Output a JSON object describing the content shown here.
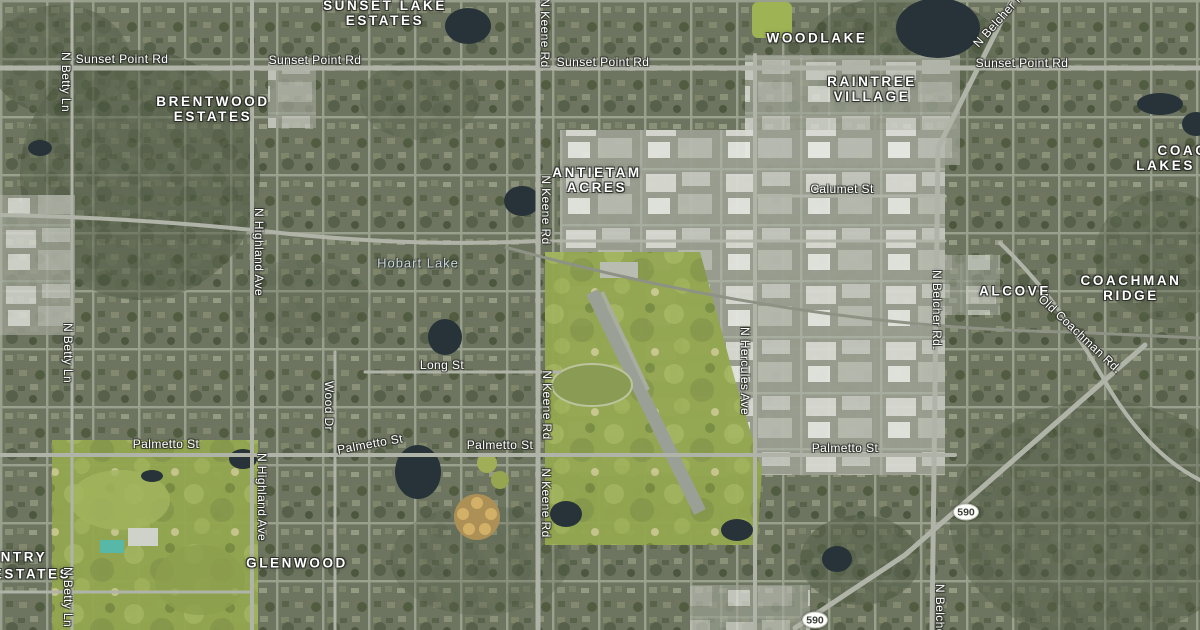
{
  "map": {
    "type": "satellite",
    "colors": {
      "label_text": "#ffffff",
      "water_label_text": "#c9d3d9",
      "residential": "#6d7560",
      "trees": "#4d5740",
      "golf": "#93a64f",
      "industrial_roof": "#d8dad3",
      "road": "#b0b4a8",
      "water": "#273339",
      "shield_bg": "#fdfdf9"
    },
    "place_labels": [
      {
        "lines": [
          "SUNSET LAKE",
          "ESTATES"
        ],
        "x": 385,
        "y": 13
      },
      {
        "lines": [
          "WOODLAKE"
        ],
        "x": 817,
        "y": 38
      },
      {
        "lines": [
          "BRENTWOOD",
          "ESTATES"
        ],
        "x": 213,
        "y": 109
      },
      {
        "lines": [
          "RAINTREE",
          "VILLAGE"
        ],
        "x": 872,
        "y": 89
      },
      {
        "lines": [
          "ANTIETAM",
          "ACRES"
        ],
        "x": 597,
        "y": 180
      },
      {
        "lines": [
          "COACHMAN",
          "LAKES ESTATES"
        ],
        "x": 1208,
        "y": 158
      },
      {
        "lines": [
          "ALCOVE"
        ],
        "x": 1015,
        "y": 291
      },
      {
        "lines": [
          "COACHMAN",
          "RIDGE"
        ],
        "x": 1131,
        "y": 288
      },
      {
        "lines": [
          "GLENWOOD"
        ],
        "x": 297,
        "y": 563
      },
      {
        "lines": [
          "COUNTRY"
        ],
        "x": 5,
        "y": 557
      },
      {
        "lines": [
          "ESTATES"
        ],
        "x": 32,
        "y": 574
      }
    ],
    "road_labels": [
      {
        "text": "Sunset Point Rd",
        "x": 122,
        "y": 59,
        "rotate": 0
      },
      {
        "text": "Sunset Point Rd",
        "x": 315,
        "y": 60,
        "rotate": 0
      },
      {
        "text": "Sunset Point Rd",
        "x": 603,
        "y": 62,
        "rotate": 0
      },
      {
        "text": "Sunset Point Rd",
        "x": 1022,
        "y": 63,
        "rotate": 0
      },
      {
        "text": "N Betty Ln",
        "x": 66,
        "y": 82,
        "rotate": 90
      },
      {
        "text": "N Betty Ln",
        "x": 68,
        "y": 353,
        "rotate": 90
      },
      {
        "text": "N Betty Ln",
        "x": 68,
        "y": 597,
        "rotate": 90
      },
      {
        "text": "N Keene Rd",
        "x": 545,
        "y": 33,
        "rotate": 90
      },
      {
        "text": "N Keene Rd",
        "x": 546,
        "y": 210,
        "rotate": 90
      },
      {
        "text": "N Keene Rd",
        "x": 547,
        "y": 405,
        "rotate": 90
      },
      {
        "text": "N Keene Rd",
        "x": 546,
        "y": 503,
        "rotate": 90
      },
      {
        "text": "N Belcher Rd",
        "x": 1001,
        "y": 17,
        "rotate": -48
      },
      {
        "text": "N Belcher Rd.",
        "x": 937,
        "y": 310,
        "rotate": 90
      },
      {
        "text": "N Belcher Rd",
        "x": 940,
        "y": 622,
        "rotate": 90
      },
      {
        "text": "N Highland Ave",
        "x": 259,
        "y": 252,
        "rotate": 90
      },
      {
        "text": "N Highland Ave",
        "x": 262,
        "y": 497,
        "rotate": 90
      },
      {
        "text": "Wood Dr",
        "x": 329,
        "y": 406,
        "rotate": 90
      },
      {
        "text": "Long St",
        "x": 442,
        "y": 365,
        "rotate": 0
      },
      {
        "text": "Palmetto St",
        "x": 166,
        "y": 444,
        "rotate": 0
      },
      {
        "text": "Palmetto St",
        "x": 370,
        "y": 444,
        "rotate": -10
      },
      {
        "text": "Palmetto St",
        "x": 500,
        "y": 445,
        "rotate": 0
      },
      {
        "text": "Palmetto St",
        "x": 845,
        "y": 448,
        "rotate": 0
      },
      {
        "text": "Calumet St",
        "x": 842,
        "y": 189,
        "rotate": 0
      },
      {
        "text": "N Hercules Ave",
        "x": 745,
        "y": 371,
        "rotate": 90
      },
      {
        "text": "Old Coachman Rd.",
        "x": 1080,
        "y": 334,
        "rotate": 43
      }
    ],
    "water_labels": [
      {
        "text": "Hobart Lake",
        "x": 418,
        "y": 263
      }
    ],
    "route_shields": [
      {
        "text": "590",
        "x": 966,
        "y": 512
      },
      {
        "text": "590",
        "x": 815,
        "y": 620
      }
    ]
  }
}
